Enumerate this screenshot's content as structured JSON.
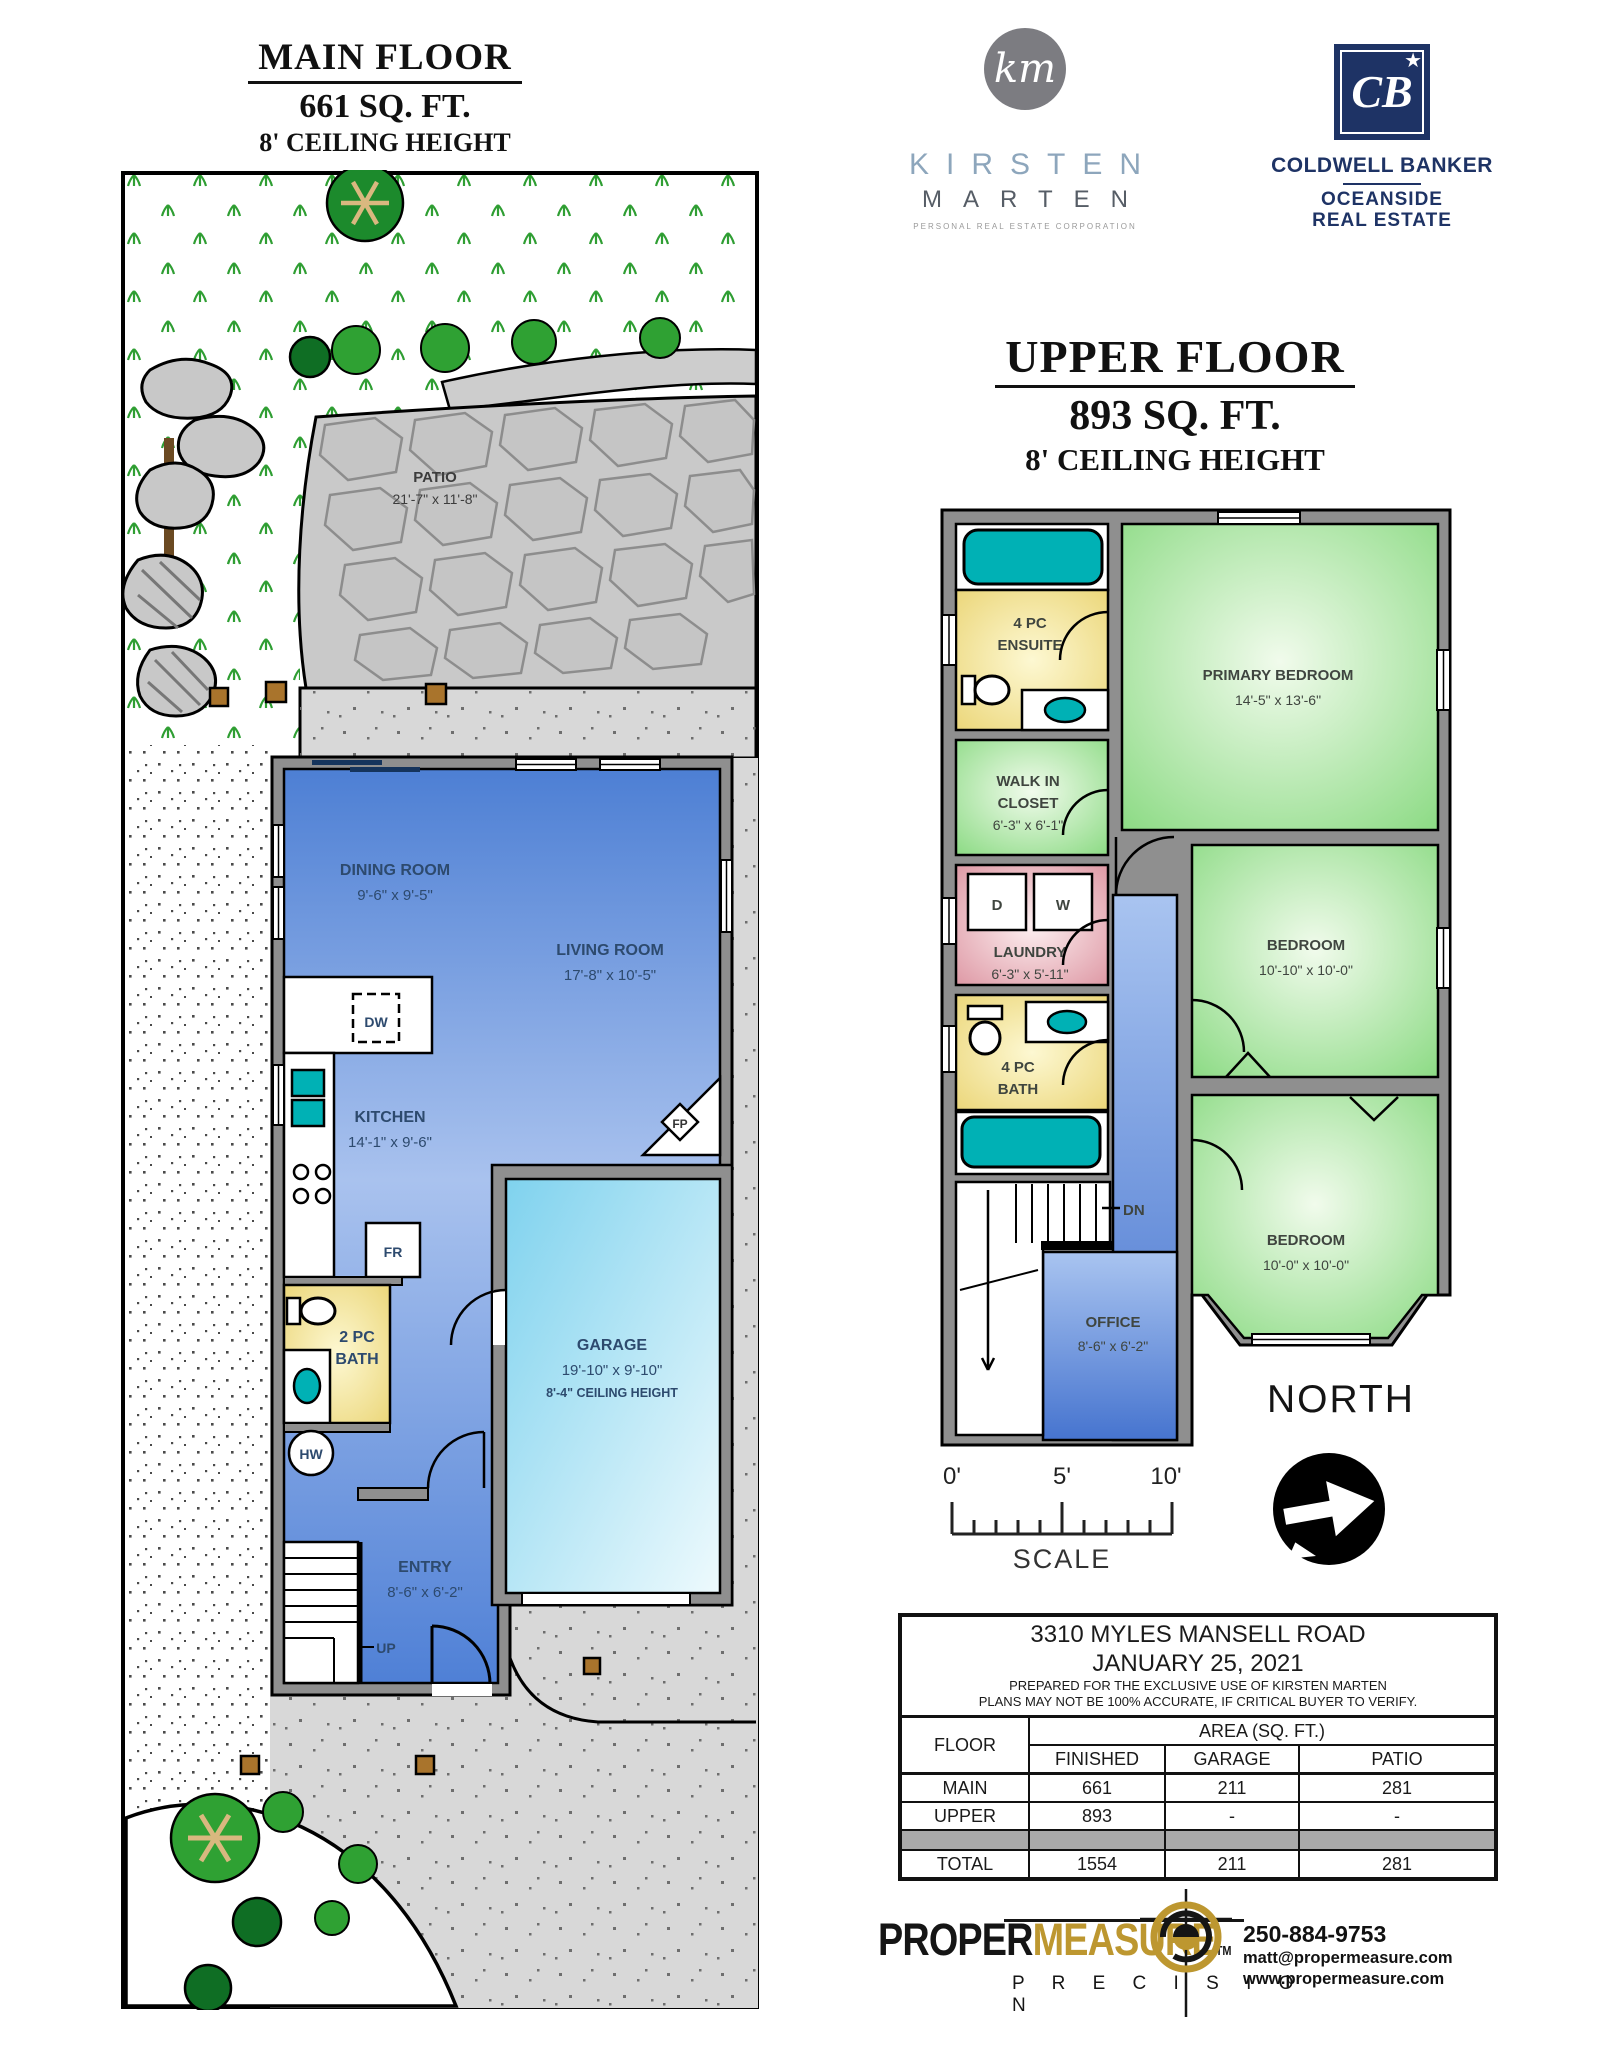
{
  "main_floor": {
    "title": "MAIN FLOOR",
    "area": "661 SQ. FT.",
    "ceiling": "8' CEILING HEIGHT",
    "patio_name": "PATIO",
    "patio_dims": "21'-7\" x 11'-8\"",
    "dining_name": "DINING ROOM",
    "dining_dims": "9'-6\" x 9'-5\"",
    "living_name": "LIVING ROOM",
    "living_dims": "17'-8\" x 10'-5\"",
    "kitchen_name": "KITCHEN",
    "kitchen_dims": "14'-1\" x 9'-6\"",
    "bath_l1": "2 PC",
    "bath_l2": "BATH",
    "garage_name": "GARAGE",
    "garage_dims": "19'-10\" x 9'-10\"",
    "garage_ceiling": "8'-4\" CEILING HEIGHT",
    "entry_name": "ENTRY",
    "entry_dims": "8'-6\" x 6'-2\"",
    "dw": "DW",
    "fr": "FR",
    "fp": "FP",
    "hw": "HW",
    "up": "UP"
  },
  "upper_floor": {
    "title": "UPPER FLOOR",
    "area": "893 SQ. FT.",
    "ceiling": "8' CEILING HEIGHT",
    "ensuite_l1": "4 PC",
    "ensuite_l2": "ENSUITE",
    "primary_name": "PRIMARY BEDROOM",
    "primary_dims": "14'-5\" x 13'-6\"",
    "closet_l1": "WALK IN",
    "closet_l2": "CLOSET",
    "closet_dims": "6'-3\" x 6'-1\"",
    "laundry_name": "LAUNDRY",
    "laundry_dims": "6'-3\" x 5'-11\"",
    "dryer": "D",
    "washer": "W",
    "bath_l1": "4 PC",
    "bath_l2": "BATH",
    "bedroom2_name": "BEDROOM",
    "bedroom2_dims": "10'-10\" x 10'-0\"",
    "bedroom3_name": "BEDROOM",
    "bedroom3_dims": "10'-0\" x 10'-0\"",
    "office_name": "OFFICE",
    "office_dims": "8'-6\" x 6'-2\"",
    "dn": "DN"
  },
  "branding": {
    "km_monogram": "km",
    "km_first": "KIRSTEN",
    "km_last": "MARTEN",
    "km_tagline": "PERSONAL REAL ESTATE CORPORATION",
    "cb_monogram": "CB",
    "cb_star": "★",
    "cb_name": "COLDWELL BANKER",
    "cb_sub1": "OCEANSIDE",
    "cb_sub2": "REAL ESTATE"
  },
  "compass": {
    "label": "NORTH"
  },
  "scale_bar": {
    "t0": "0'",
    "t5": "5'",
    "t10": "10'",
    "label": "SCALE"
  },
  "info_table": {
    "address": "3310 MYLES MANSELL ROAD",
    "date": "JANUARY 25, 2021",
    "prepared": "PREPARED FOR THE EXCLUSIVE USE OF KIRSTEN MARTEN",
    "disclaimer": "PLANS MAY NOT BE 100% ACCURATE, IF CRITICAL BUYER TO VERIFY.",
    "col_floor": "FLOOR",
    "col_area": "AREA (SQ. FT.)",
    "col_finished": "FINISHED",
    "col_garage": "GARAGE",
    "col_patio": "PATIO",
    "rows": [
      {
        "floor": "MAIN",
        "finished": "661",
        "garage": "211",
        "patio": "281"
      },
      {
        "floor": "UPPER",
        "finished": "893",
        "garage": "-",
        "patio": "-"
      }
    ],
    "total_label": "TOTAL",
    "total_finished": "1554",
    "total_garage": "211",
    "total_patio": "281"
  },
  "footer": {
    "brand_black": "PROPER",
    "brand_gold": "MEASURE",
    "tm": "TM",
    "brand_sub": "P R E C I S I O N",
    "phone": "250-884-9753",
    "email": "matt@propermeasure.com",
    "web": "www.propermeasure.com"
  }
}
